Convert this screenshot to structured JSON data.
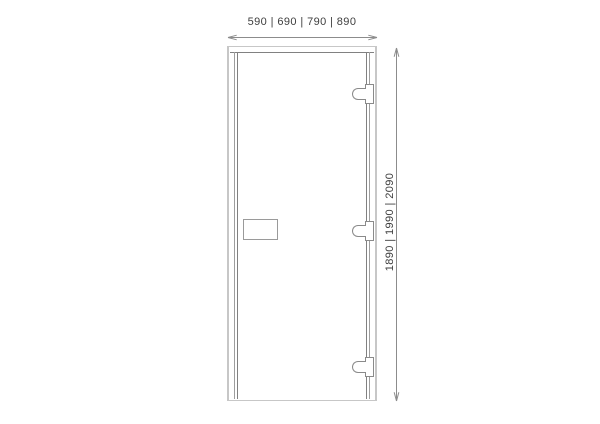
{
  "diagram": {
    "type": "door-technical-drawing",
    "dimensions": {
      "width_label": "590 | 690 | 790 | 890",
      "width_options_mm": [
        590,
        690,
        790,
        890
      ],
      "height_label": "1890 | 1990 | 2090",
      "height_options_mm": [
        1890,
        1990,
        2090
      ]
    },
    "components": {
      "door_frame": "door-frame",
      "door_leaf": "door-leaf",
      "glass_panel": "glass-panel",
      "handle": "handle-plate",
      "hinges": [
        "hinge-top",
        "hinge-middle",
        "hinge-bottom"
      ]
    },
    "colors": {
      "background": "#ffffff",
      "frame_outline": "#c7c7c7",
      "leaf_outline": "#818181",
      "dimension_line": "#8c8c8c",
      "text": "#3e3e3e"
    }
  }
}
